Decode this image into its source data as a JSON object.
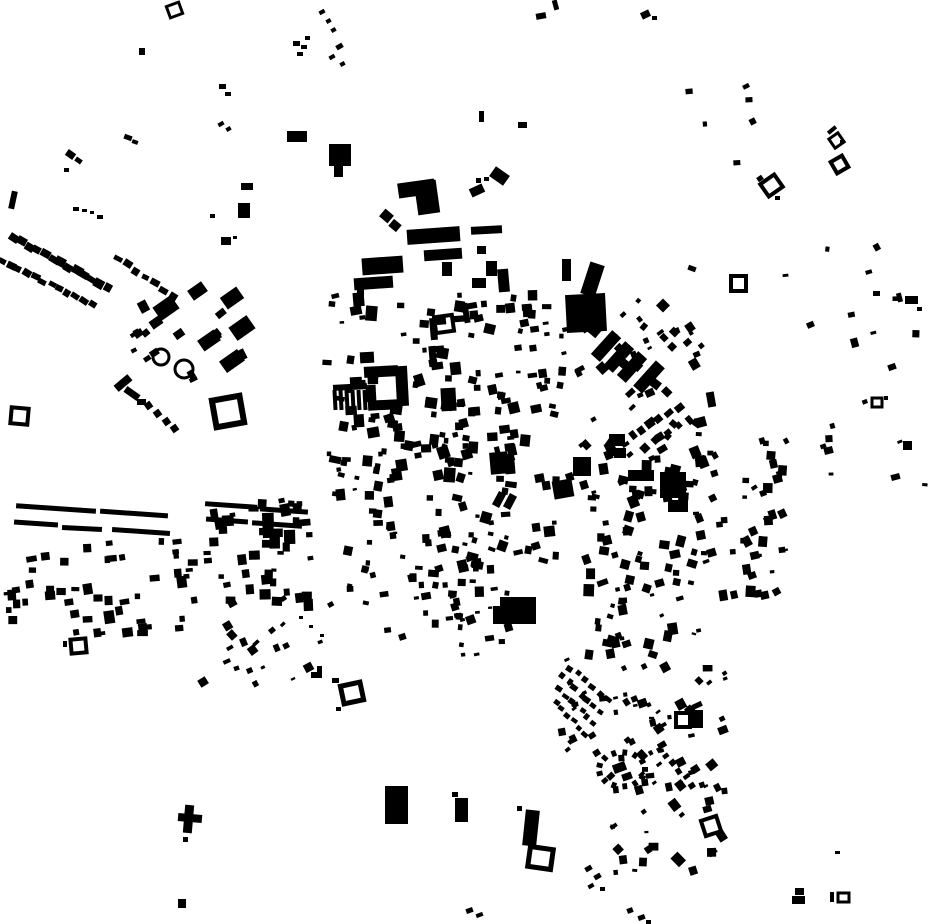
{
  "map": {
    "width": 930,
    "height": 924,
    "background_color": "#ffffff",
    "building_color": "#000000",
    "buildings": [
      [
        139,
        48,
        6,
        7,
        0
      ],
      [
        124,
        135,
        8,
        5,
        20
      ],
      [
        132,
        140,
        6,
        4,
        20
      ],
      [
        66,
        151,
        9,
        7,
        35
      ],
      [
        75,
        158,
        7,
        5,
        35
      ],
      [
        64,
        168,
        5,
        4,
        0
      ],
      [
        10,
        191,
        6,
        18,
        12
      ],
      [
        73,
        207,
        6,
        4,
        0
      ],
      [
        82,
        209,
        5,
        3,
        0
      ],
      [
        90,
        211,
        4,
        3,
        0
      ],
      [
        97,
        215,
        6,
        4,
        0
      ],
      [
        219,
        84,
        7,
        5,
        0
      ],
      [
        225,
        92,
        6,
        4,
        0
      ],
      [
        218,
        122,
        6,
        4,
        -30
      ],
      [
        226,
        127,
        5,
        4,
        -30
      ],
      [
        287,
        131,
        20,
        11,
        0
      ],
      [
        329,
        144,
        22,
        22,
        0
      ],
      [
        334,
        166,
        9,
        11,
        0
      ],
      [
        293,
        41,
        7,
        5,
        0
      ],
      [
        301,
        45,
        6,
        4,
        0
      ],
      [
        305,
        36,
        5,
        4,
        0
      ],
      [
        297,
        52,
        6,
        4,
        0
      ],
      [
        241,
        183,
        12,
        7,
        0
      ],
      [
        238,
        203,
        12,
        15,
        0
      ],
      [
        210,
        214,
        5,
        4,
        0
      ],
      [
        221,
        237,
        10,
        8,
        0
      ],
      [
        233,
        236,
        4,
        3,
        0
      ],
      [
        319,
        10,
        6,
        4,
        -30
      ],
      [
        326,
        19,
        5,
        4,
        -30
      ],
      [
        331,
        28,
        5,
        4,
        -30
      ],
      [
        336,
        44,
        7,
        5,
        -30
      ],
      [
        329,
        55,
        6,
        4,
        -30
      ],
      [
        340,
        62,
        5,
        4,
        -30
      ],
      [
        189,
        285,
        17,
        12,
        -35
      ],
      [
        222,
        291,
        20,
        14,
        -35
      ],
      [
        155,
        300,
        22,
        16,
        -35
      ],
      [
        231,
        320,
        22,
        16,
        -35
      ],
      [
        199,
        334,
        20,
        13,
        -35
      ],
      [
        221,
        354,
        22,
        14,
        -35
      ],
      [
        174,
        330,
        10,
        8,
        -35
      ],
      [
        150,
        318,
        12,
        9,
        -35
      ],
      [
        134,
        330,
        9,
        7,
        -35
      ],
      [
        114,
        379,
        18,
        8,
        -40
      ],
      [
        124,
        390,
        16,
        7,
        35
      ],
      [
        137,
        399,
        9,
        6,
        0
      ],
      [
        145,
        402,
        7,
        7,
        -35
      ],
      [
        154,
        410,
        7,
        7,
        -35
      ],
      [
        163,
        418,
        7,
        7,
        -35
      ],
      [
        171,
        425,
        7,
        7,
        -35
      ],
      [
        398,
        181,
        37,
        15,
        -8
      ],
      [
        416,
        181,
        22,
        33,
        -8
      ],
      [
        381,
        211,
        11,
        10,
        40
      ],
      [
        390,
        221,
        10,
        9,
        40
      ],
      [
        407,
        228,
        53,
        15,
        -4
      ],
      [
        424,
        249,
        38,
        11,
        -4
      ],
      [
        442,
        262,
        10,
        14,
        0
      ],
      [
        362,
        257,
        41,
        17,
        -4
      ],
      [
        354,
        277,
        39,
        12,
        -4
      ],
      [
        357,
        289,
        7,
        9,
        0
      ],
      [
        476,
        178,
        5,
        5,
        0
      ],
      [
        484,
        177,
        5,
        4,
        0
      ],
      [
        491,
        170,
        17,
        12,
        35
      ],
      [
        470,
        186,
        14,
        9,
        -25
      ],
      [
        471,
        226,
        31,
        8,
        -3
      ],
      [
        486,
        261,
        11,
        15,
        0
      ],
      [
        472,
        278,
        14,
        10,
        0
      ],
      [
        498,
        269,
        11,
        23,
        -5
      ],
      [
        477,
        246,
        9,
        8,
        0
      ],
      [
        518,
        122,
        9,
        6,
        0
      ],
      [
        479,
        111,
        5,
        11,
        0
      ],
      [
        536,
        13,
        10,
        6,
        -10
      ],
      [
        553,
        0,
        5,
        10,
        -15
      ],
      [
        641,
        11,
        9,
        7,
        -25
      ],
      [
        652,
        16,
        5,
        4,
        0
      ],
      [
        562,
        259,
        9,
        22,
        0
      ],
      [
        585,
        263,
        15,
        33,
        18
      ],
      [
        566,
        294,
        40,
        38,
        -3
      ],
      [
        600,
        330,
        12,
        32,
        42
      ],
      [
        613,
        341,
        12,
        32,
        42
      ],
      [
        626,
        351,
        12,
        32,
        42
      ],
      [
        643,
        360,
        12,
        34,
        42
      ],
      [
        688,
        266,
        8,
        5,
        20
      ],
      [
        757,
        176,
        6,
        5,
        -35
      ],
      [
        775,
        196,
        5,
        4,
        0
      ],
      [
        827,
        128,
        10,
        4,
        -40
      ],
      [
        840,
        140,
        4,
        4,
        0
      ],
      [
        897,
        293,
        5,
        9,
        -15
      ],
      [
        905,
        296,
        13,
        8,
        0
      ],
      [
        917,
        307,
        5,
        4,
        0
      ],
      [
        873,
        291,
        7,
        5,
        0
      ],
      [
        888,
        364,
        8,
        6,
        -20
      ],
      [
        884,
        396,
        4,
        4,
        0
      ],
      [
        903,
        441,
        9,
        9,
        0
      ],
      [
        824,
        447,
        9,
        7,
        -15
      ],
      [
        891,
        474,
        9,
        6,
        -15
      ],
      [
        364,
        366,
        34,
        11,
        -3
      ],
      [
        396,
        366,
        12,
        40,
        -3
      ],
      [
        368,
        400,
        30,
        10,
        -3
      ],
      [
        366,
        385,
        10,
        17,
        -3
      ],
      [
        350,
        377,
        12,
        12,
        -3
      ],
      [
        360,
        352,
        14,
        11,
        -3
      ],
      [
        333,
        384,
        34,
        6,
        -3
      ],
      [
        441,
        388,
        15,
        23,
        -3
      ],
      [
        333,
        390,
        4,
        20,
        -3
      ],
      [
        339,
        390,
        4,
        20,
        -3
      ],
      [
        345,
        390,
        4,
        20,
        -3
      ],
      [
        351,
        390,
        4,
        20,
        -3
      ],
      [
        357,
        390,
        4,
        20,
        -3
      ],
      [
        363,
        390,
        4,
        20,
        -3
      ],
      [
        430,
        318,
        7,
        22,
        -5
      ],
      [
        430,
        318,
        16,
        7,
        -5
      ],
      [
        429,
        346,
        7,
        16,
        -5
      ],
      [
        429,
        346,
        15,
        6,
        -5
      ],
      [
        463,
        303,
        6,
        20,
        -10
      ],
      [
        463,
        303,
        14,
        6,
        -10
      ],
      [
        490,
        452,
        18,
        22,
        -5
      ],
      [
        505,
        460,
        10,
        14,
        -5
      ],
      [
        495,
        492,
        8,
        15,
        28
      ],
      [
        506,
        494,
        8,
        15,
        28
      ],
      [
        553,
        480,
        20,
        18,
        -10
      ],
      [
        573,
        457,
        18,
        19,
        0
      ],
      [
        628,
        470,
        26,
        11,
        0
      ],
      [
        660,
        472,
        26,
        26,
        0
      ],
      [
        668,
        500,
        20,
        12,
        0
      ],
      [
        609,
        434,
        16,
        12,
        0
      ],
      [
        614,
        448,
        12,
        10,
        0
      ],
      [
        707,
        392,
        8,
        15,
        -10
      ],
      [
        697,
        417,
        9,
        10,
        -15
      ],
      [
        385,
        786,
        23,
        38,
        0
      ],
      [
        452,
        792,
        6,
        5,
        0
      ],
      [
        455,
        798,
        13,
        24,
        0
      ],
      [
        500,
        597,
        36,
        15,
        0
      ],
      [
        493,
        606,
        43,
        18,
        0
      ],
      [
        524,
        810,
        14,
        36,
        6
      ],
      [
        517,
        806,
        5,
        5,
        0
      ],
      [
        466,
        908,
        7,
        5,
        -20
      ],
      [
        476,
        913,
        7,
        4,
        -20
      ],
      [
        184,
        805,
        9,
        28,
        5
      ],
      [
        178,
        814,
        24,
        8,
        5
      ],
      [
        183,
        837,
        5,
        5,
        0
      ],
      [
        178,
        899,
        8,
        9,
        0
      ],
      [
        336,
        707,
        5,
        4,
        0
      ],
      [
        299,
        616,
        4,
        3,
        0
      ],
      [
        309,
        625,
        4,
        3,
        0
      ],
      [
        320,
        634,
        4,
        3,
        0
      ],
      [
        311,
        672,
        10,
        6,
        0
      ],
      [
        317,
        666,
        5,
        12,
        0
      ],
      [
        332,
        678,
        7,
        5,
        0
      ],
      [
        63,
        641,
        4,
        6,
        0
      ],
      [
        692,
        710,
        11,
        18,
        0
      ],
      [
        795,
        888,
        9,
        7,
        0
      ],
      [
        792,
        896,
        13,
        8,
        0
      ],
      [
        830,
        892,
        4,
        10,
        0
      ],
      [
        835,
        851,
        5,
        3,
        0
      ],
      [
        585,
        866,
        7,
        5,
        -30
      ],
      [
        594,
        874,
        7,
        5,
        -30
      ],
      [
        588,
        884,
        6,
        4,
        -30
      ],
      [
        600,
        887,
        5,
        4,
        0
      ],
      [
        627,
        908,
        6,
        5,
        -20
      ],
      [
        638,
        915,
        7,
        5,
        -20
      ],
      [
        646,
        920,
        5,
        4,
        0
      ],
      [
        613,
        763,
        13,
        9,
        -20
      ],
      [
        622,
        773,
        10,
        7,
        -20
      ],
      [
        16,
        506,
        80,
        5,
        4
      ],
      [
        100,
        511,
        68,
        5,
        4
      ],
      [
        14,
        521,
        44,
        5,
        4
      ],
      [
        62,
        526,
        40,
        5,
        3
      ],
      [
        112,
        529,
        58,
        5,
        4
      ],
      [
        205,
        503,
        52,
        5,
        4
      ],
      [
        260,
        508,
        48,
        5,
        4
      ],
      [
        206,
        518,
        42,
        5,
        4
      ],
      [
        252,
        522,
        50,
        5,
        4
      ]
    ],
    "hollow": [
      [
        168,
        4,
        13,
        12,
        3,
        -20
      ],
      [
        214,
        398,
        28,
        27,
        6,
        -10
      ],
      [
        11,
        408,
        17,
        16,
        4,
        5
      ],
      [
        731,
        276,
        15,
        15,
        4,
        0
      ],
      [
        763,
        178,
        17,
        15,
        4,
        -35
      ],
      [
        831,
        135,
        11,
        11,
        3,
        -35
      ],
      [
        833,
        158,
        13,
        13,
        4,
        -30
      ],
      [
        872,
        398,
        10,
        9,
        3,
        0
      ],
      [
        435,
        316,
        18,
        16,
        4,
        -8
      ],
      [
        342,
        684,
        20,
        18,
        5,
        -12
      ],
      [
        71,
        639,
        15,
        14,
        4,
        -5
      ],
      [
        529,
        848,
        23,
        20,
        5,
        8
      ],
      [
        676,
        713,
        14,
        14,
        4,
        0
      ],
      [
        703,
        818,
        16,
        16,
        4,
        -18
      ],
      [
        838,
        893,
        11,
        9,
        3,
        0
      ]
    ],
    "rings": [
      [
        161,
        357,
        8,
        3
      ],
      [
        184,
        369,
        9,
        3
      ]
    ],
    "rows": [
      [
        14,
        238,
        108,
        288,
        13,
        9,
        7,
        30,
        11
      ],
      [
        2,
        262,
        93,
        305,
        12,
        8,
        6,
        30,
        22
      ],
      [
        118,
        258,
        172,
        296,
        7,
        8,
        6,
        28,
        33
      ],
      [
        632,
        436,
        678,
        408,
        6,
        7,
        7,
        -40,
        44
      ],
      [
        645,
        447,
        690,
        419,
        5,
        7,
        7,
        -40,
        55
      ],
      [
        563,
        677,
        600,
        713,
        7,
        6,
        5,
        38,
        66
      ],
      [
        559,
        690,
        593,
        723,
        7,
        6,
        5,
        38,
        77
      ],
      [
        556,
        702,
        586,
        733,
        6,
        6,
        5,
        38,
        88
      ],
      [
        570,
        668,
        608,
        700,
        6,
        6,
        5,
        38,
        99
      ],
      [
        658,
        749,
        693,
        785,
        6,
        6,
        5,
        -35,
        111
      ]
    ],
    "ovals": [
      [
        622,
        770,
        23,
        17,
        13,
        6
      ]
    ],
    "clusters": [
      [
        125,
        298,
        130,
        85,
        14,
        5,
        10,
        -45,
        -25,
        1
      ],
      [
        2,
        538,
        200,
        100,
        52,
        5,
        11,
        -10,
        2,
        2
      ],
      [
        202,
        498,
        112,
        115,
        46,
        5,
        12,
        -12,
        5,
        3
      ],
      [
        320,
        292,
        148,
        182,
        74,
        4,
        12,
        -18,
        12,
        4
      ],
      [
        468,
        288,
        100,
        165,
        54,
        4,
        11,
        -15,
        15,
        5
      ],
      [
        572,
        298,
        135,
        165,
        62,
        4,
        10,
        -55,
        -20,
        6
      ],
      [
        695,
        428,
        95,
        175,
        52,
        4,
        10,
        -35,
        5,
        7
      ],
      [
        425,
        428,
        150,
        155,
        62,
        4,
        12,
        -20,
        20,
        8
      ],
      [
        578,
        455,
        125,
        205,
        82,
        4,
        11,
        -25,
        20,
        9
      ],
      [
        328,
        468,
        125,
        140,
        40,
        4,
        10,
        -15,
        15,
        10
      ],
      [
        378,
        558,
        135,
        100,
        30,
        4,
        10,
        -20,
        10,
        11
      ],
      [
        558,
        648,
        175,
        125,
        52,
        4,
        10,
        -45,
        5,
        12
      ],
      [
        598,
        768,
        135,
        115,
        36,
        4,
        10,
        -45,
        5,
        13
      ],
      [
        198,
        596,
        145,
        95,
        24,
        4,
        9,
        -45,
        -20,
        14
      ],
      [
        818,
        328,
        115,
        165,
        10,
        4,
        9,
        -30,
        10,
        15
      ],
      [
        735,
        225,
        180,
        120,
        7,
        4,
        8,
        -30,
        10,
        16
      ],
      [
        640,
        60,
        200,
        150,
        6,
        4,
        8,
        -30,
        10,
        17
      ]
    ]
  }
}
